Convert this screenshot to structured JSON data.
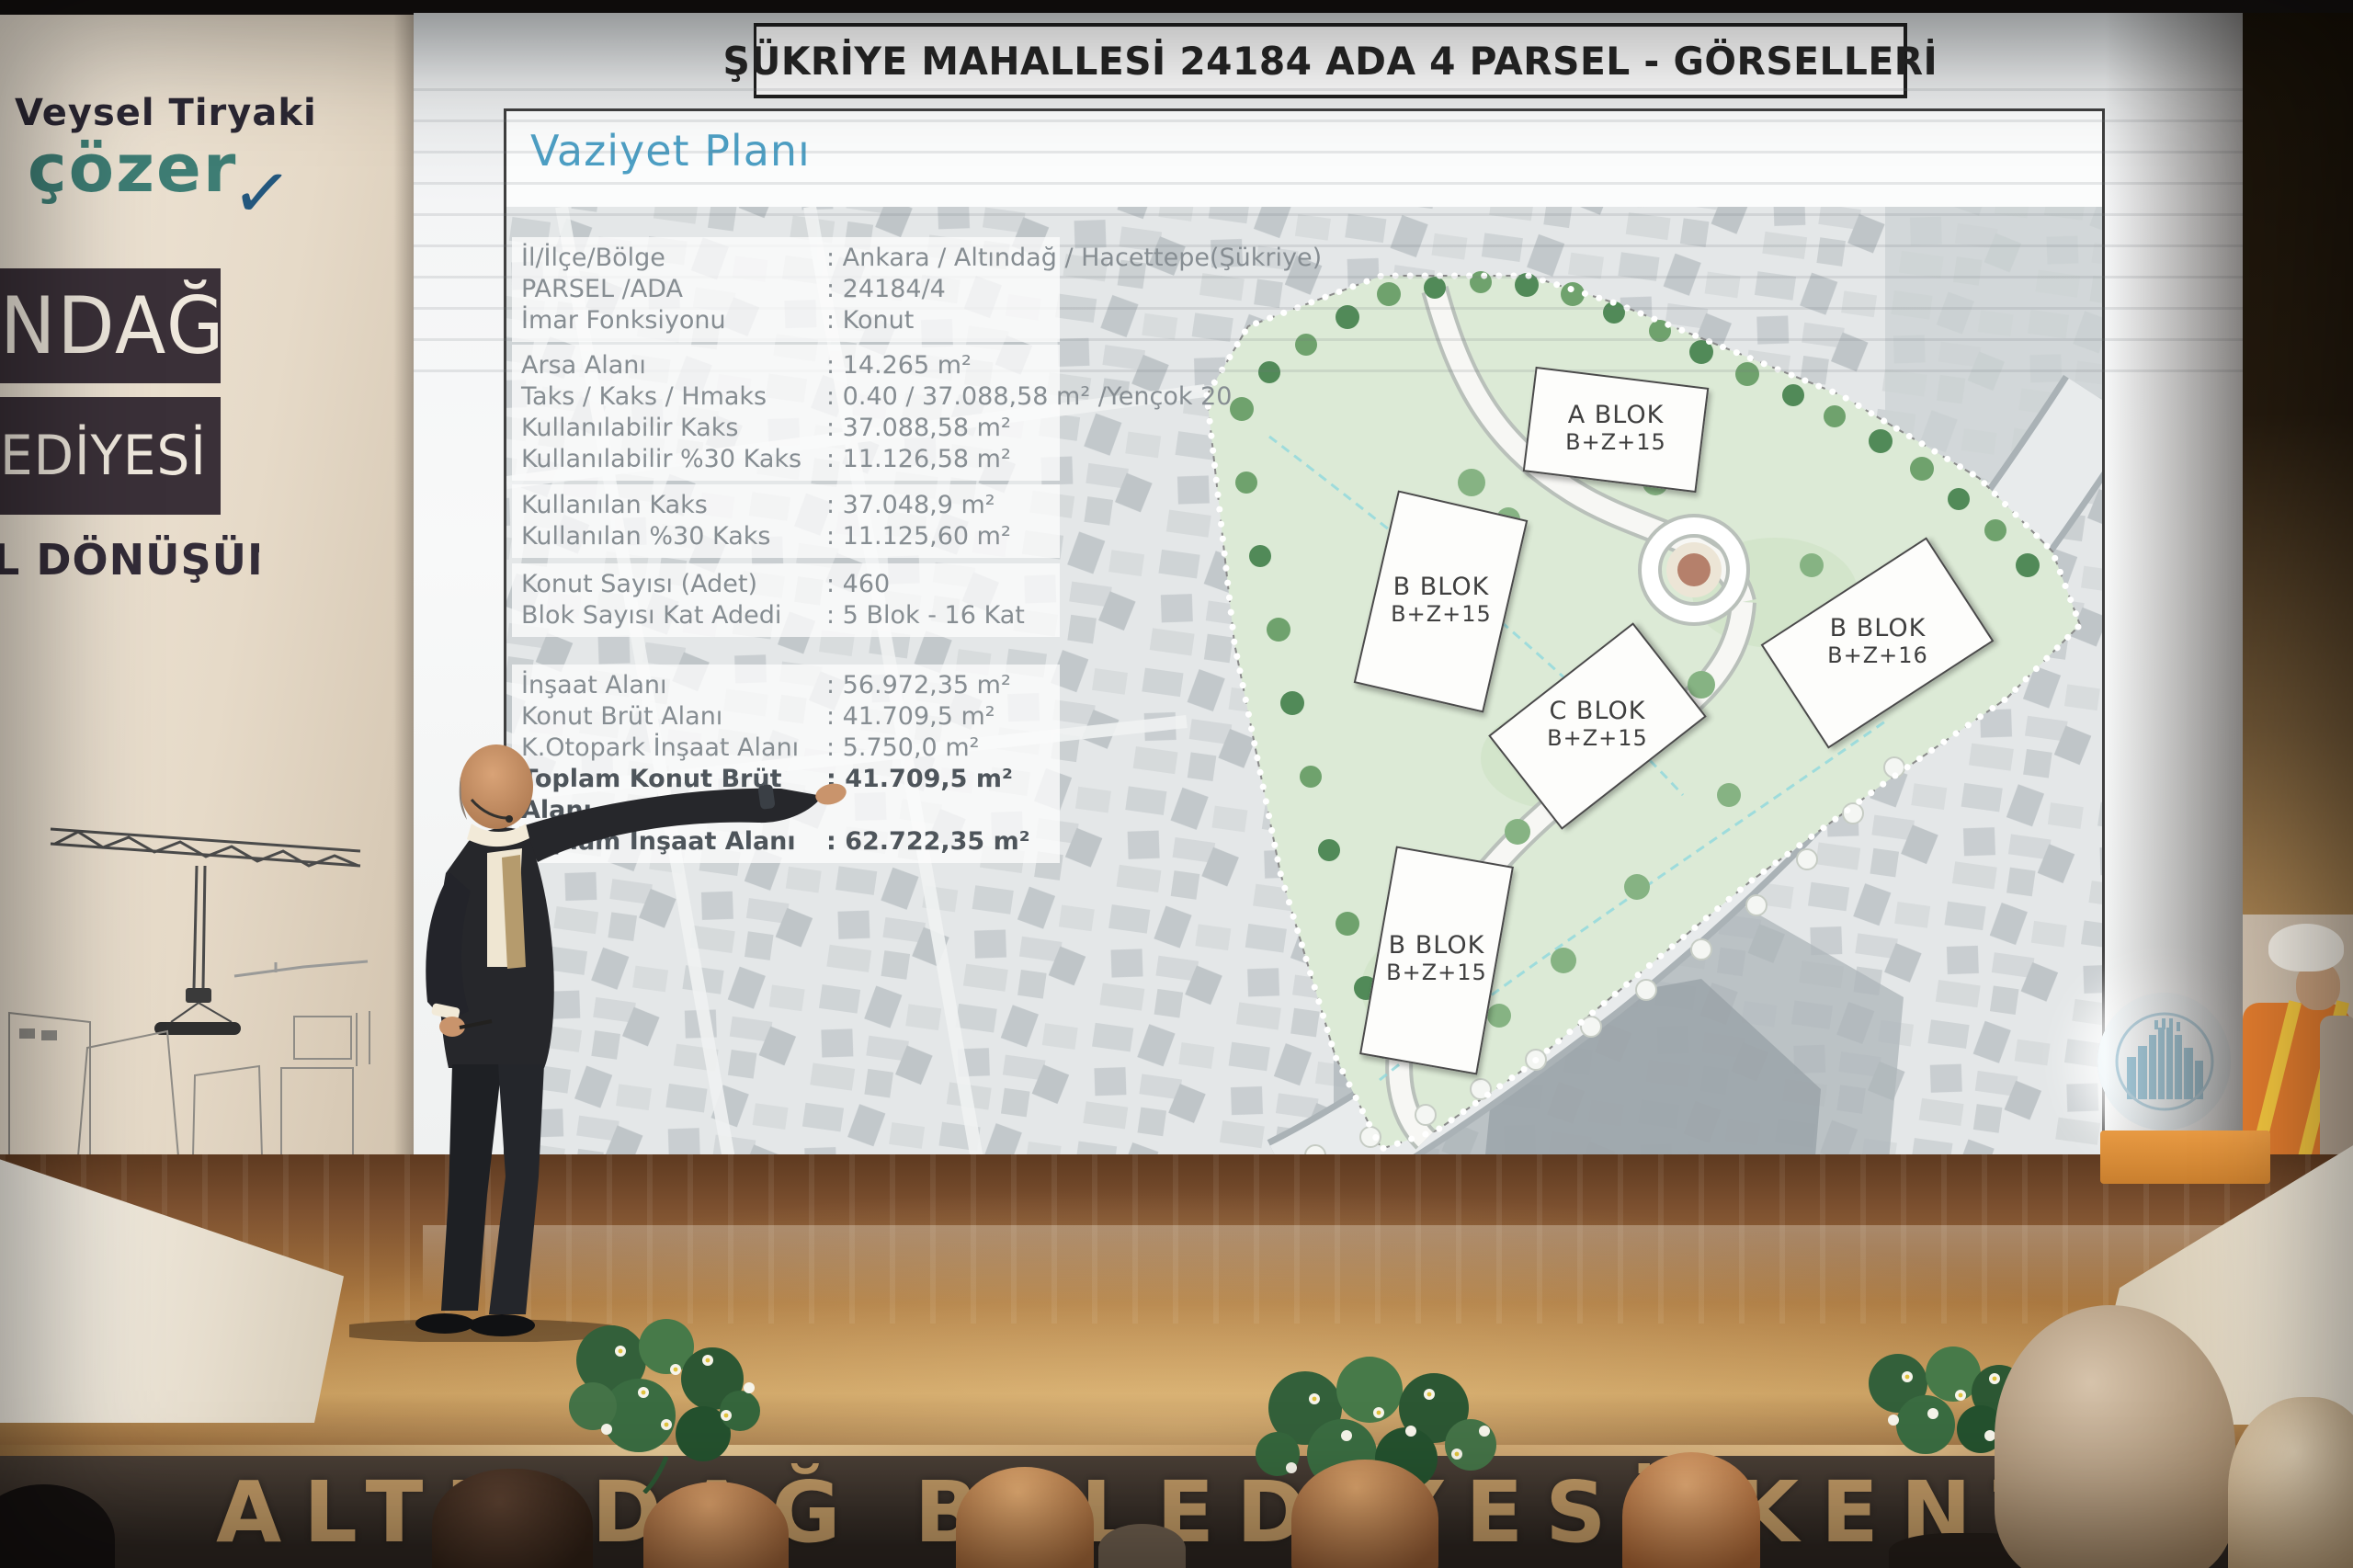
{
  "icons": {
    "checkmark": "✓"
  },
  "colors": {
    "heading_accent": "#4d9fc4",
    "brand_teal": "#3e7d74",
    "band_background": "#3a3038",
    "front_letters": "#c59d67"
  },
  "left_banner": {
    "brand_name": "Veysel Tiryaki",
    "brand_word": "çözer",
    "band1_text": "NDAĞ",
    "band2_text": "EDİYESİ",
    "band3_text": "L DÖNÜŞÜM"
  },
  "slide": {
    "title": "ŞÜKRİYE MAHALLESİ 24184 ADA 4 PARSEL - GÖRSELLERİ",
    "heading": "Vaziyet Planı",
    "info_groups": [
      {
        "rows": [
          {
            "label": "İl/İlçe/Bölge",
            "value": ": Ankara / Altındağ / Hacettepe(Şükriye)"
          },
          {
            "label": "PARSEL /ADA",
            "value": ": 24184/4"
          },
          {
            "label": "İmar Fonksiyonu",
            "value": ": Konut"
          }
        ]
      },
      {
        "rows": [
          {
            "label": "Arsa Alanı",
            "value": ": 14.265 m²"
          },
          {
            "label": "Taks / Kaks / Hmaks",
            "value": ": 0.40 / 37.088,58 m² /Yençok 20"
          },
          {
            "label": "Kullanılabilir Kaks",
            "value": ": 37.088,58 m²"
          },
          {
            "label": "Kullanılabilir %30 Kaks",
            "value": ": 11.126,58 m²"
          }
        ]
      },
      {
        "rows": [
          {
            "label": "Kullanılan Kaks",
            "value": ": 37.048,9 m²"
          },
          {
            "label": "Kullanılan %30 Kaks",
            "value": ": 11.125,60 m²"
          }
        ]
      },
      {
        "rows": [
          {
            "label": "Konut Sayısı (Adet)",
            "value": ": 460"
          },
          {
            "label": "Blok Sayısı Kat Adedi",
            "value": ": 5 Blok - 16 Kat"
          }
        ]
      },
      {
        "rows": [
          {
            "label": "İnşaat Alanı",
            "value": ": 56.972,35 m²"
          },
          {
            "label": "Konut Brüt Alanı",
            "value": ": 41.709,5 m²"
          },
          {
            "label": "K.Otopark İnşaat Alanı",
            "value": ": 5.750,0 m²"
          },
          {
            "label": "Toplam Konut Brüt Alanı",
            "value": ": 41.709,5 m²",
            "bold": true
          },
          {
            "label": "Toplam İnşaat Alanı",
            "value": ": 62.722,35 m²",
            "bold": true
          }
        ]
      }
    ],
    "blocks": [
      {
        "name": "A BLOK",
        "floors": "B+Z+15"
      },
      {
        "name": "B BLOK",
        "floors": "B+Z+15"
      },
      {
        "name": "B BLOK",
        "floors": "B+Z+16"
      },
      {
        "name": "C BLOK",
        "floors": "B+Z+15"
      },
      {
        "name": "B BLOK",
        "floors": "B+Z+15"
      }
    ]
  },
  "stage": {
    "front_text": "ALTINDAĞ BELEDİYESİ KENTSEL DÖNÜŞÜM"
  }
}
